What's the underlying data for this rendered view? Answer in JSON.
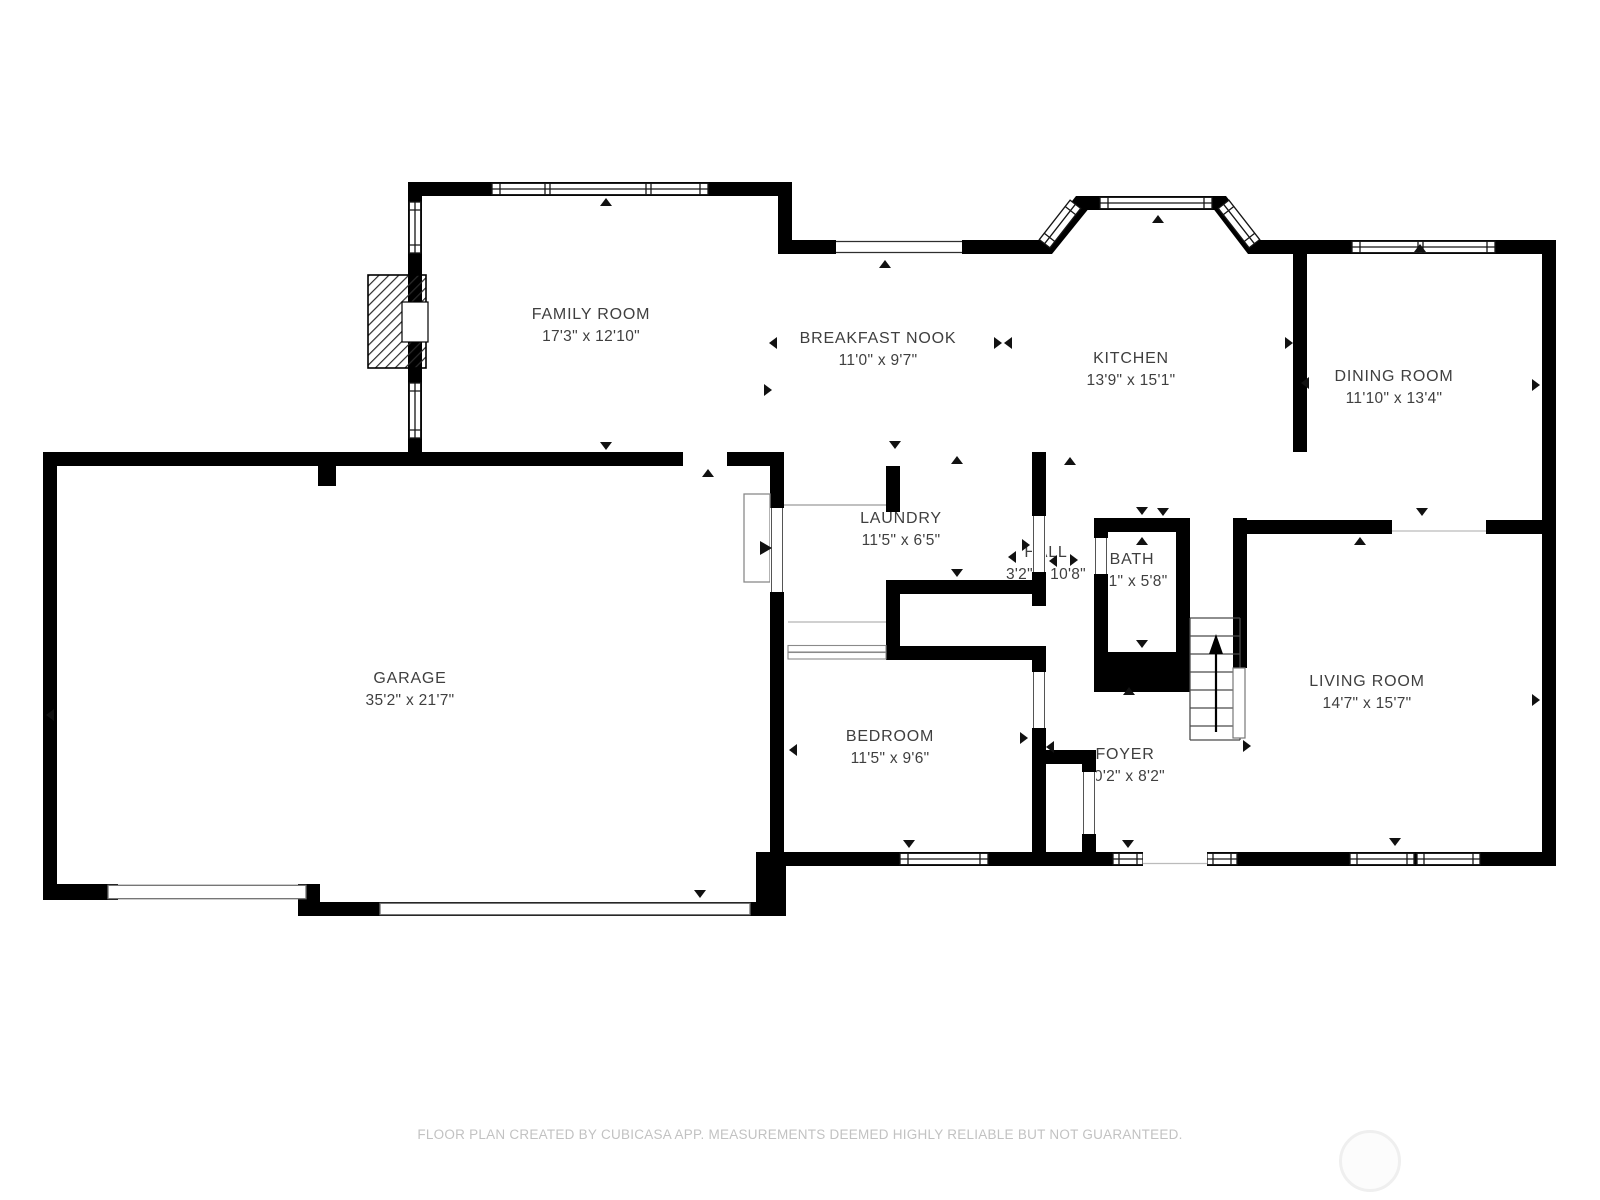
{
  "document": {
    "kind": "floor-plan",
    "creator_note": "FLOOR PLAN CREATED BY CUBICASA APP. MEASUREMENTS DEEMED HIGHLY RELIABLE BUT NOT GUARANTEED."
  },
  "rooms": [
    {
      "id": "family-room",
      "name": "FAMILY ROOM",
      "dims": "17'3\" x 12'10\""
    },
    {
      "id": "breakfast-nook",
      "name": "BREAKFAST NOOK",
      "dims": "11'0\" x 9'7\""
    },
    {
      "id": "kitchen",
      "name": "KITCHEN",
      "dims": "13'9\" x 15'1\""
    },
    {
      "id": "dining-room",
      "name": "DINING ROOM",
      "dims": "11'10\" x 13'4\""
    },
    {
      "id": "garage",
      "name": "GARAGE",
      "dims": "35'2\" x 21'7\""
    },
    {
      "id": "laundry",
      "name": "LAUNDRY",
      "dims": "11'5\" x 6'5\""
    },
    {
      "id": "hall",
      "name": "HALL",
      "dims": "3'2\" x 10'8\""
    },
    {
      "id": "bath",
      "name": "BATH",
      "dims": "3'1\" x 5'8\""
    },
    {
      "id": "bedroom",
      "name": "BEDROOM",
      "dims": "11'5\" x 9'6\""
    },
    {
      "id": "foyer",
      "name": "FOYER",
      "dims": "10'2\" x 8'2\""
    },
    {
      "id": "living-room",
      "name": "LIVING ROOM",
      "dims": "14'7\" x 15'7\""
    }
  ],
  "footer": {
    "text": "FLOOR PLAN CREATED BY CUBICASA APP. MEASUREMENTS DEEMED HIGHLY RELIABLE BUT NOT GUARANTEED."
  },
  "icons": {
    "stairs_direction": "up-arrow",
    "door_markers": "small-triangle-ticks"
  },
  "colors": {
    "wall": "#000000",
    "room_label": "#3f3f3f",
    "footer_text": "#c2c2c2",
    "thin_line": "#8a8a8a",
    "watermark": "#efefef",
    "background": "#ffffff"
  }
}
